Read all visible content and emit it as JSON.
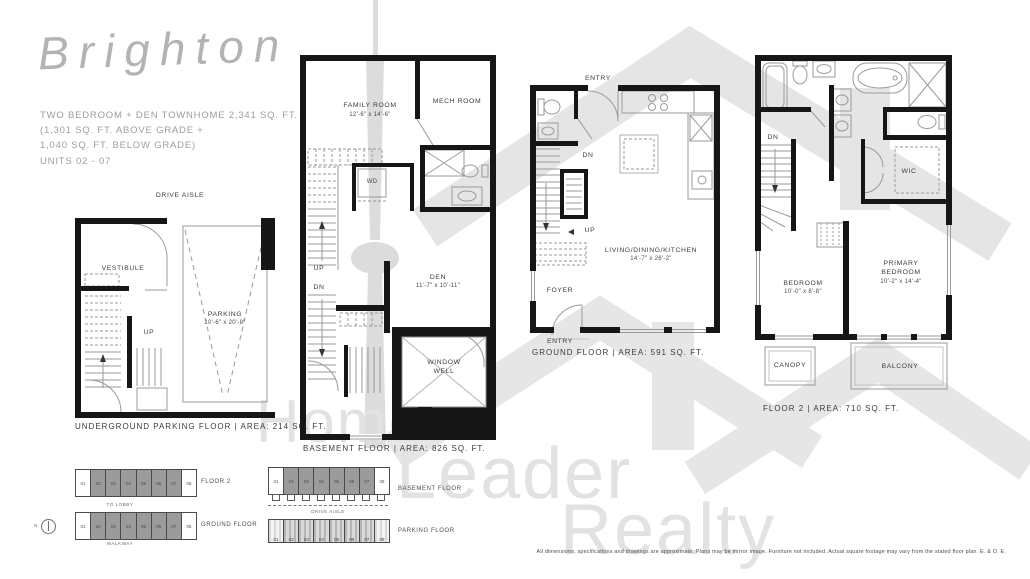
{
  "title": "Brighton",
  "summary": {
    "line1": "TWO BEDROOM + DEN TOWNHOME  2,341 SQ. FT.",
    "line2": "(1,301 SQ. FT. ABOVE GRADE +",
    "line3": "1,040 SQ. FT. BELOW GRADE)",
    "line4": "UNITS 02 - 07"
  },
  "top_labels": {
    "drive_aisle": "DRIVE AISLE"
  },
  "plans": {
    "underground": {
      "caption": "UNDERGROUND PARKING FLOOR   |   AREA: 214 SQ. FT.",
      "vestibule": "VESTIBULE",
      "up": "UP",
      "parking_name": "PARKING",
      "parking_dim": "10'-6\" x 20'-8\""
    },
    "basement": {
      "caption": "BASEMENT FLOOR   |   AREA: 826 SQ. FT.",
      "family_room": "FAMILY ROOM",
      "family_room_dim": "12'-6\" x 14'-6\"",
      "mech_room": "MECH ROOM",
      "wd": "WD",
      "up": "UP",
      "dn": "DN",
      "den": "DEN",
      "den_dim": "11'-7\" x 10'-11\"",
      "window_well": "WINDOW\nWELL"
    },
    "ground": {
      "caption": "GROUND FLOOR   |   AREA: 591 SQ. FT.",
      "entry_top": "ENTRY",
      "dn": "DN",
      "up": "UP",
      "room": "LIVING/DINING/KITCHEN",
      "room_dim": "14'-7\" x 26'-2\"",
      "foyer": "FOYER",
      "entry_bottom": "ENTRY"
    },
    "floor2": {
      "caption": "FLOOR 2   |   AREA: 710 SQ. FT.",
      "dn": "DN",
      "wic": "WIC",
      "bedroom": "BEDROOM",
      "bedroom_dim": "10'-0\" x 8'-8\"",
      "primary": "PRIMARY\nBEDROOM",
      "primary_dim": "10'-2\" x 14'-4\"",
      "canopy": "CANOPY",
      "balcony": "BALCONY"
    }
  },
  "keyplans": {
    "units": [
      "01",
      "02",
      "03",
      "04",
      "05",
      "06",
      "07",
      "08"
    ],
    "floor2_label": "FLOOR 2",
    "ground_label": "GROUND FLOOR",
    "basement_label": "BASEMENT FLOOR",
    "parking_label": "PARKING FLOOR",
    "to_lobby": "TO LOBBY",
    "walkway": "WALKWAY",
    "drive_aisle": "DRIVE AISLE",
    "north": "N"
  },
  "watermark": {
    "word1": "Home",
    "word2": "Leader",
    "word3": "Realty"
  },
  "disclaimer": "All dimensions, specifications and drawings are approximate. Plans may be mirror image. Furniture not included. Actual square footage may vary from the stated floor plan. E. & O. E."
}
